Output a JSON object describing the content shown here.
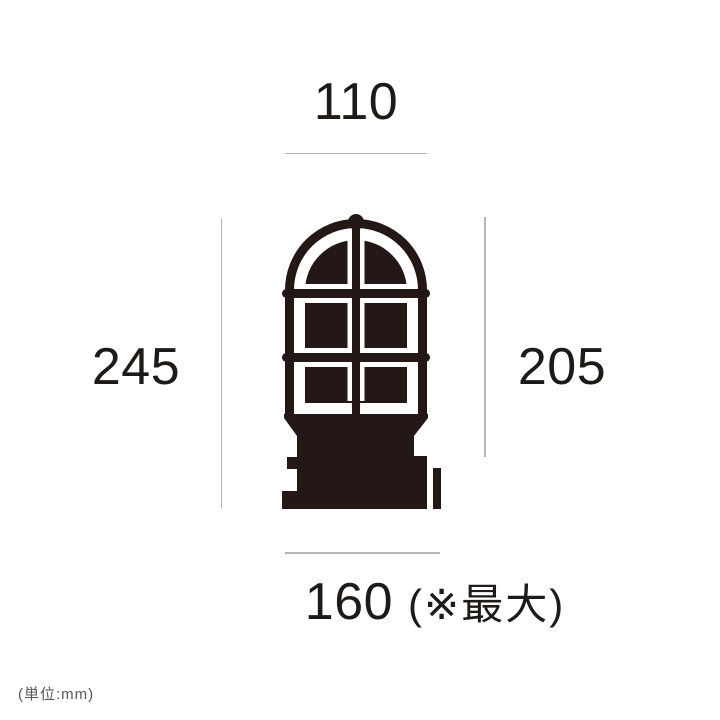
{
  "diagram": {
    "dimensions": {
      "width_top": "110",
      "height_left": "245",
      "height_right": "205",
      "width_bottom": "160",
      "width_bottom_note": "(※最大)"
    },
    "unit_note": "(単位:mm)",
    "colors": {
      "ink": "#231815",
      "dim-line": "#b5b5b6",
      "label": "#1e1a17",
      "muted": "#595757"
    }
  }
}
